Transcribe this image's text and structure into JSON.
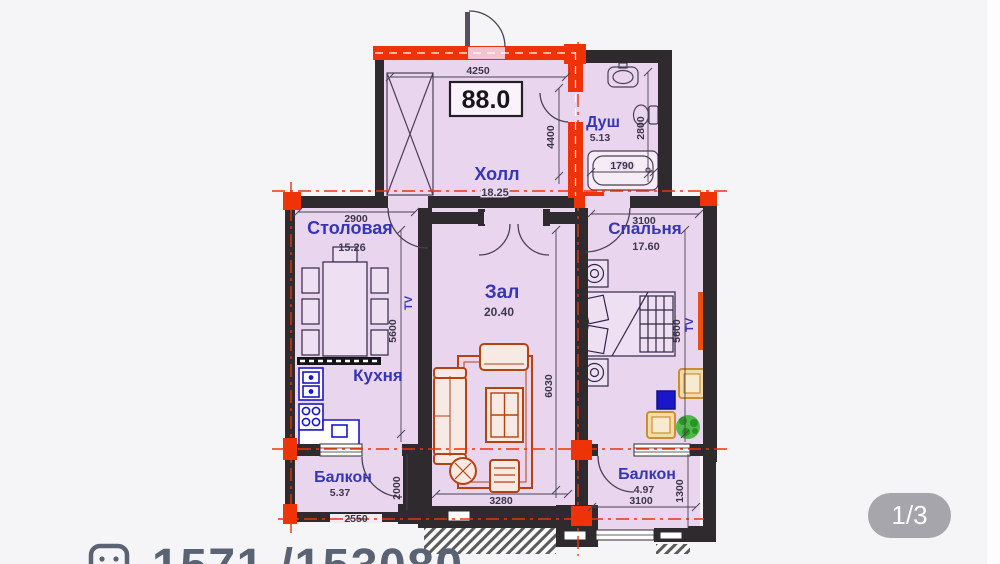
{
  "page": {
    "pager_label": "1/3",
    "listing_number": "1571 /153080"
  },
  "plan": {
    "total_area_label": "88.0",
    "tv_label": "TV",
    "rooms": {
      "hall": {
        "name": "Холл",
        "area": "18.25"
      },
      "shower": {
        "name": "Душ",
        "area": "5.13"
      },
      "dining": {
        "name": "Столовая",
        "area": "15.26"
      },
      "bedroom": {
        "name": "Спальня",
        "area": "17.60"
      },
      "living": {
        "name": "Зал",
        "area": "20.40"
      },
      "kitchen": {
        "name": "Кухня"
      },
      "balcony_left": {
        "name": "Балкон",
        "area": "5.37"
      },
      "balcony_right": {
        "name": "Балкон",
        "area": "4.97"
      }
    },
    "dimensions": {
      "hall_width": "4250",
      "hall_depth": "4400",
      "shower_depth": "2800",
      "shower_tub": "1790",
      "dining_width": "2900",
      "bedroom_width": "3100",
      "dining_depth": "5600",
      "bedroom_depth": "5600",
      "living_depth": "6030",
      "living_width": "3280",
      "balcony_left_depth": "2000",
      "balcony_left_width": "2550",
      "balcony_right_width": "3100",
      "balcony_right_depth": "1300"
    }
  },
  "colors": {
    "page-bg": "#f5f5f7",
    "wall": "#2e2a2e",
    "accent-red": "#ee3309",
    "room-fill": "#e9d6ee",
    "label-blue": "#3635b5",
    "kitchen-blue": "#1b16c9",
    "sofa-red": "#b5430f",
    "tan": "#cd8f2e",
    "plant-green": "#3db637",
    "listing-color": "#5a6373",
    "pager-bg": "#9b9ba1"
  }
}
